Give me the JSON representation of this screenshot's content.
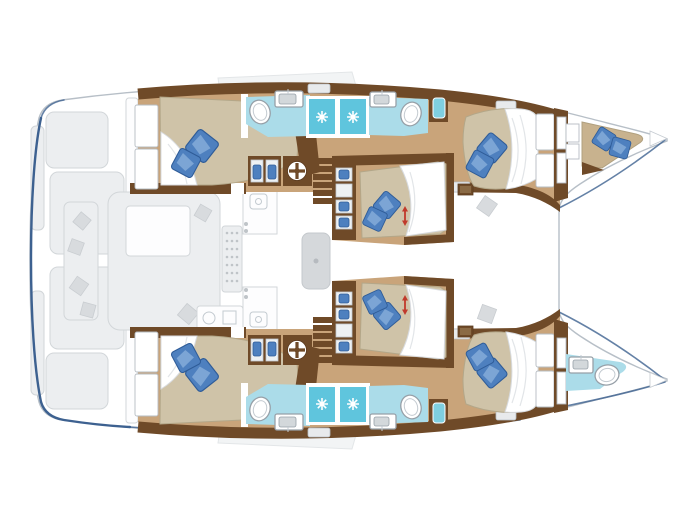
{
  "page": {
    "background": "#ffffff"
  },
  "floorplan": {
    "type": "catamaran-deck-plan",
    "orientation": "bow-right",
    "hulls": [
      "port",
      "starboard"
    ],
    "rooms": {
      "port_hull": [
        "aft-double-cabin",
        "aft-head",
        "twin-shower-cells",
        "forward-head",
        "forward-double-cabin",
        "bow-crew-cabin"
      ],
      "starboard_hull": [
        "aft-double-cabin",
        "aft-head",
        "twin-shower-cells",
        "forward-head",
        "forward-double-cabin",
        "bow-head"
      ],
      "bridgedeck": [
        "aft-cockpit",
        "cockpit-table",
        "salon-table",
        "galley-counters",
        "port-mid-cabin",
        "starboard-mid-cabin",
        "companionway-stairs-port",
        "companionway-stairs-starboard"
      ]
    },
    "bed_count": 7,
    "pillow_pair_count": 7,
    "shower_star_count": 4,
    "toilet_sink_oval_count": 5,
    "red_adjust_arrow_count": 2
  },
  "colors": {
    "background": "#ffffff",
    "hull_stroke": "#b7bfc7",
    "navy_accent": "#3d6190",
    "ghost_fill": "#eceef0",
    "ghost_stroke": "#d2d6d9",
    "ghost_dark": "#d8dbde",
    "floor_tan": "#c9a47a",
    "wall_brown": "#6f4a28",
    "wall_brown_dark": "#5a3a1f",
    "mattress": "#cfc3a8",
    "mattress_shadow": "#b3a789",
    "pillow_blue": "#4e80bf",
    "pillow_light": "#85acd8",
    "pillow_dark": "#2f5c98",
    "bath_floor": "#abdce9",
    "shower_tile": "#5fc5dd",
    "fixture_stroke": "#97a0a8",
    "arrow_red": "#c0392b",
    "hatch_fill": "#e8eaec"
  }
}
